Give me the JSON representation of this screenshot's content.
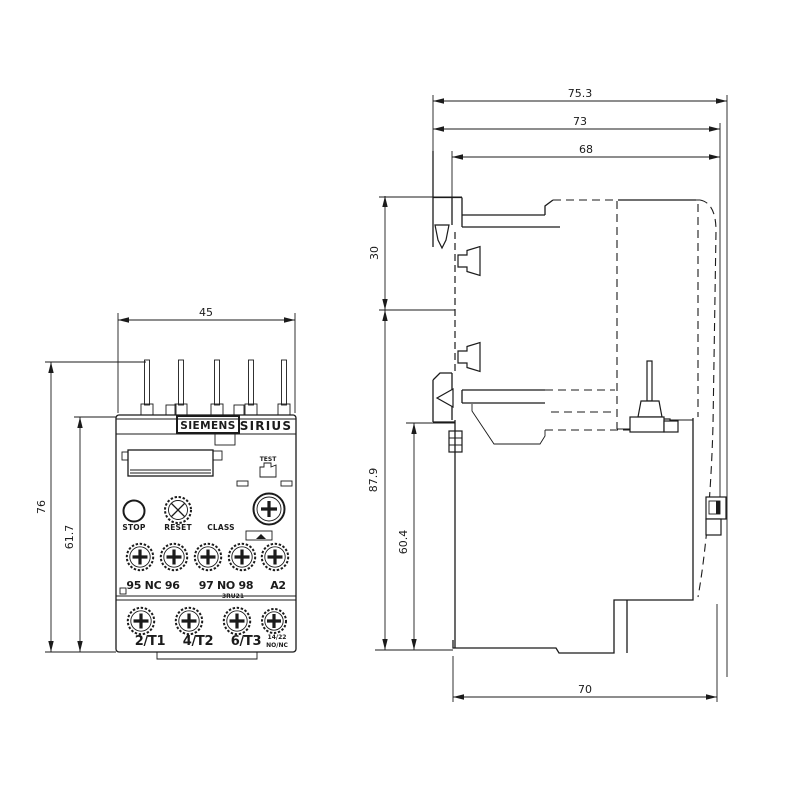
{
  "front": {
    "dims": {
      "width": "45",
      "total_height": "76",
      "body_height": "61.7"
    },
    "brand": "SIEMENS",
    "series": "SIRIUS",
    "test": "TEST",
    "stop": "STOP",
    "reset": "RESET",
    "class_label": "CLASS",
    "model": "3RU21",
    "mid_terminals": {
      "nc": "95 NC 96",
      "no": "97 NO 98",
      "a2": "A2"
    },
    "bottom_terminals": {
      "t1": "2/T1",
      "t2": "4/T2",
      "t3": "6/T3",
      "aux1": "14/22",
      "aux2": "NO/NC"
    }
  },
  "side": {
    "dims": {
      "depth_total": "75.3",
      "depth_mid": "73",
      "depth_body": "68",
      "din_offset": "30",
      "height_total": "87.9",
      "height_body": "60.4",
      "depth_bottom": "70"
    }
  }
}
